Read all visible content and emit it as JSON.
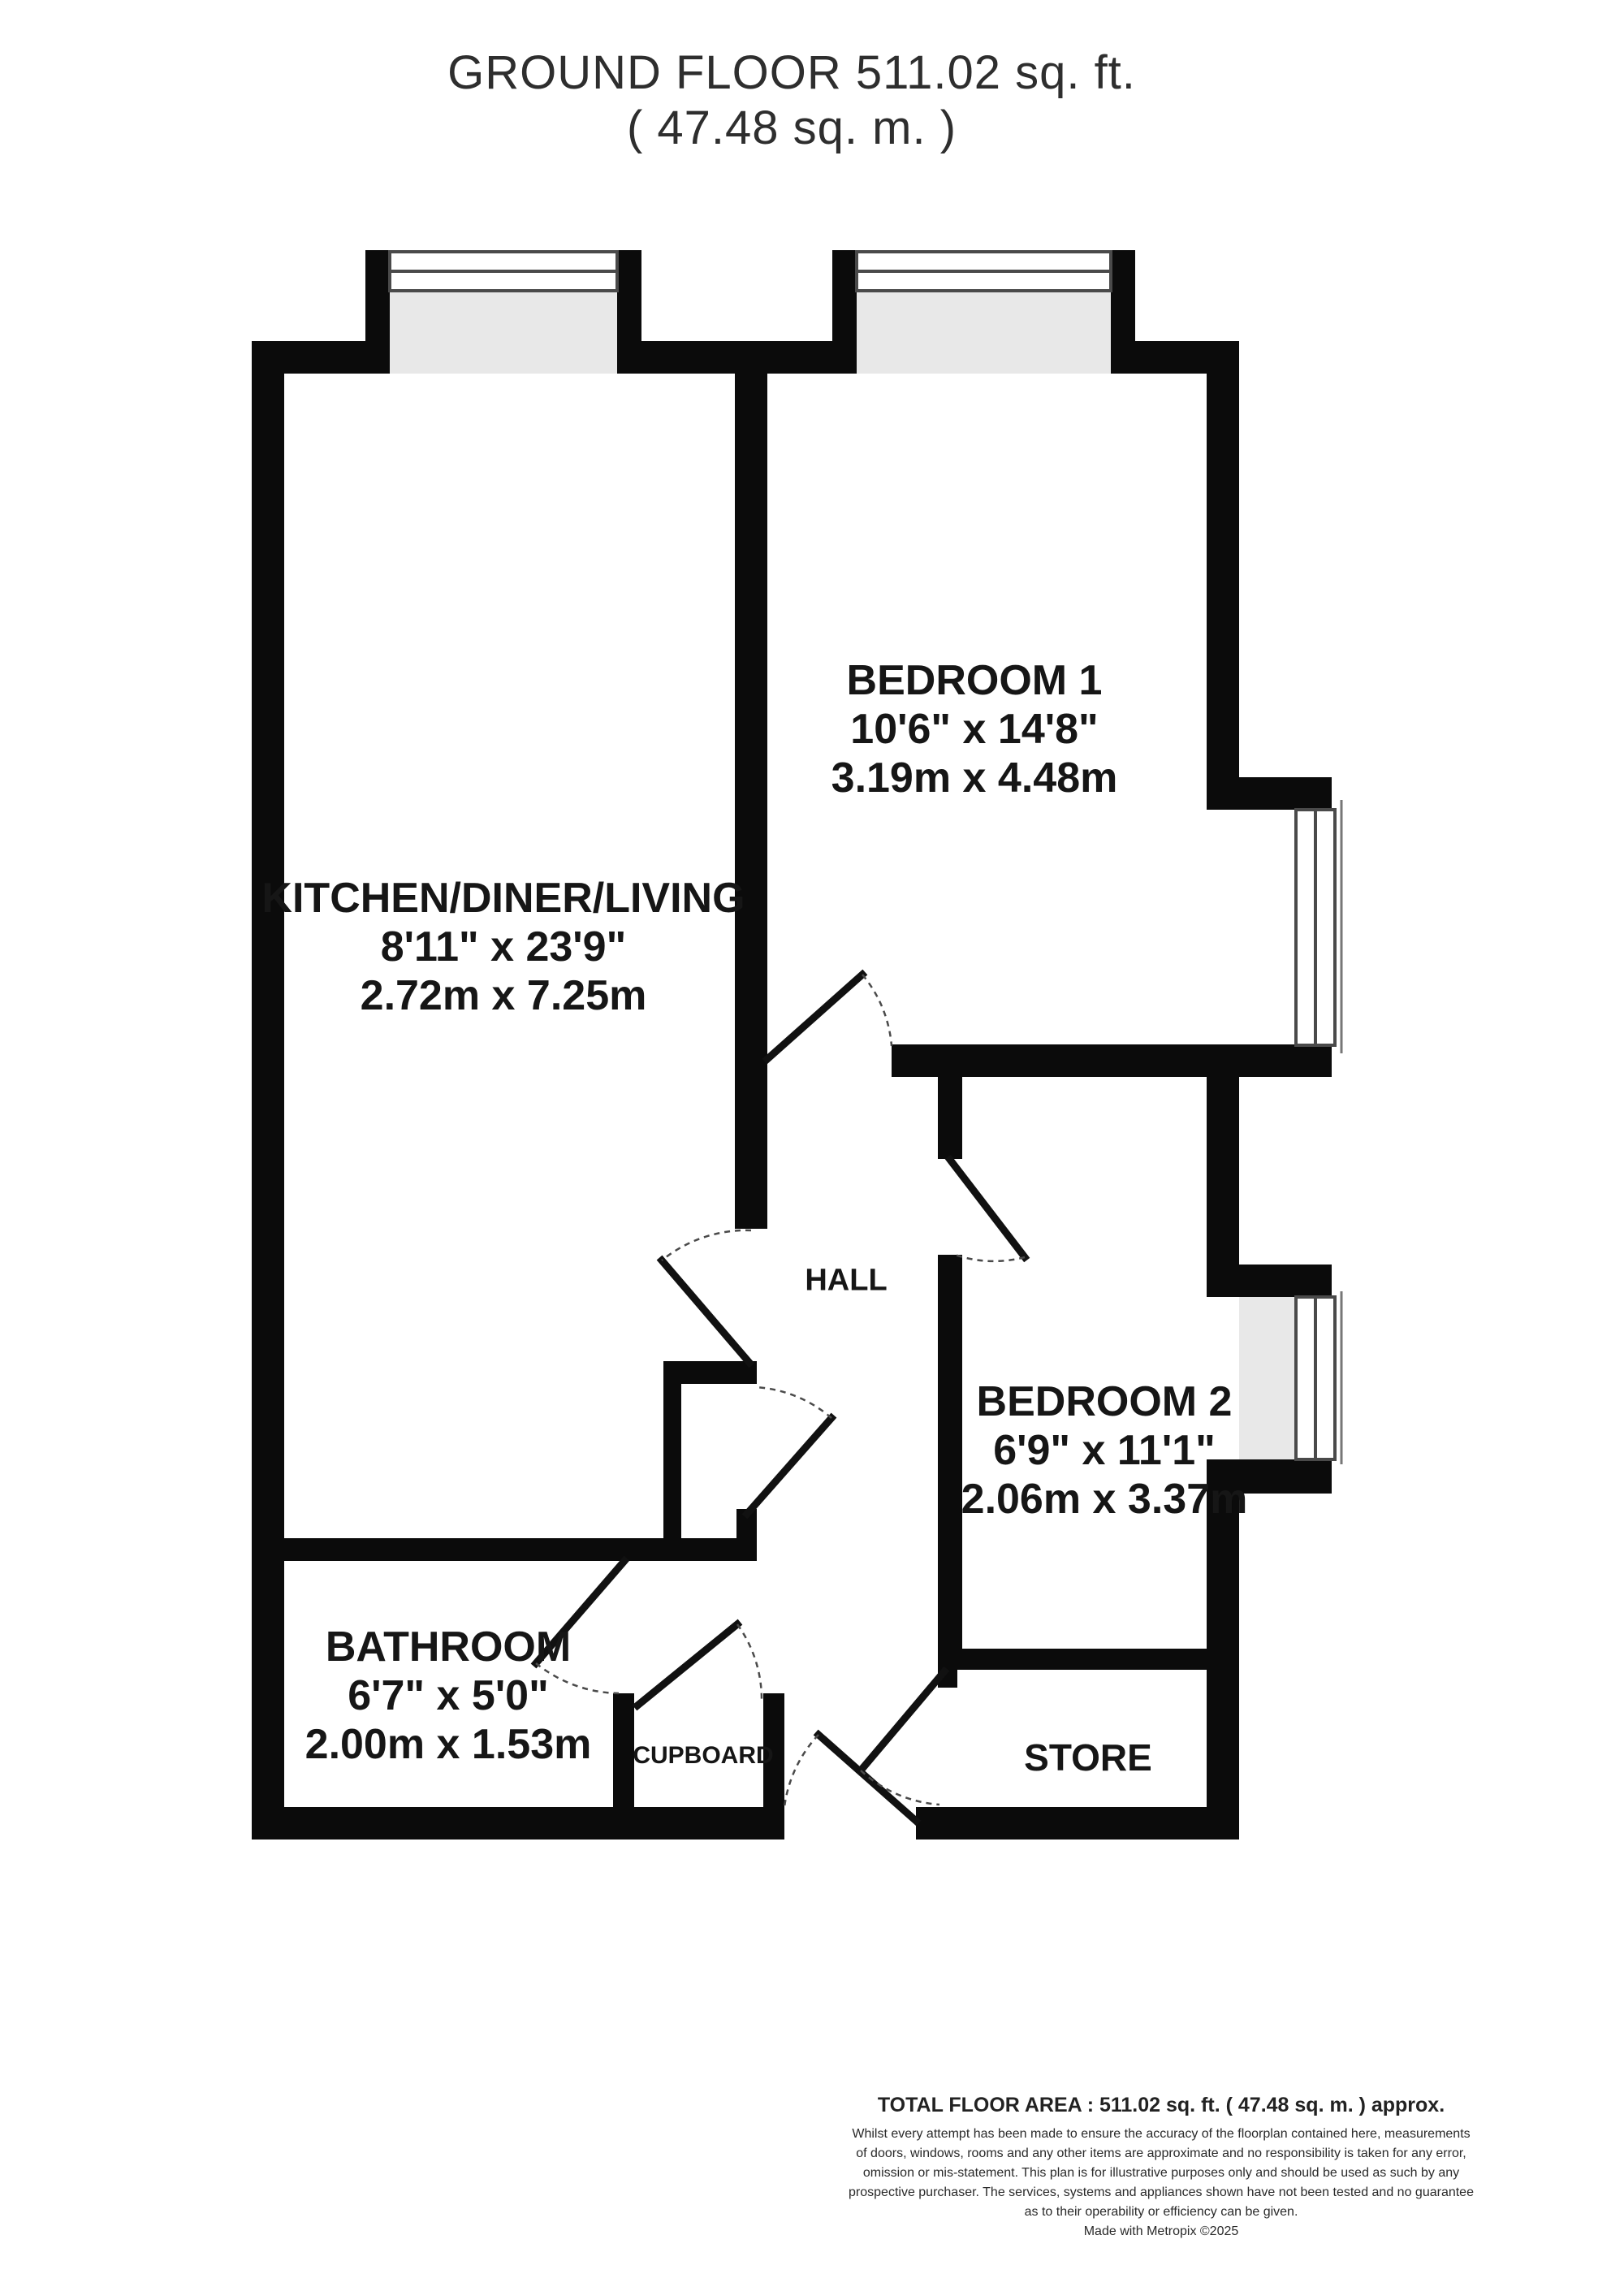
{
  "title": {
    "line1": "GROUND FLOOR 511.02 sq. ft.",
    "line2": "( 47.48 sq. m. )"
  },
  "rooms": {
    "bedroom1": {
      "name": "BEDROOM 1",
      "imperial": "10'6\" x 14'8\"",
      "metric": "3.19m x 4.48m"
    },
    "kitchen": {
      "name": "KITCHEN/DINER/LIVING",
      "imperial": "8'11\" x 23'9\"",
      "metric": "2.72m x 7.25m"
    },
    "bedroom2": {
      "name": "BEDROOM 2",
      "imperial": "6'9\" x 11'1\"",
      "metric": "2.06m x 3.37m"
    },
    "bathroom": {
      "name": "BATHROOM",
      "imperial": "6'7\" x 5'0\"",
      "metric": "2.00m x 1.53m"
    },
    "hall": {
      "name": "HALL"
    },
    "cupboard": {
      "name": "CUPBOARD"
    },
    "store": {
      "name": "STORE"
    }
  },
  "footer": {
    "total": "TOTAL FLOOR AREA : 511.02 sq. ft. ( 47.48 sq. m. ) approx.",
    "disclaimer": [
      "Whilst every attempt has been made to ensure the accuracy of the floorplan contained here, measurements",
      "of doors, windows, rooms and any other items are approximate and no responsibility is taken for any error,",
      "omission or mis-statement. This plan is for illustrative purposes only and should be used as such by any",
      "prospective purchaser. The services, systems and appliances shown have not been tested and no guarantee",
      "as to their operability or efficiency can be given."
    ],
    "credit": "Made with Metropix ©2025"
  },
  "colors": {
    "wall": "#0b0b0b",
    "window_recess": "#e8e8e8",
    "window_line": "#4a4a4a",
    "door_arc": "#4a4a4a",
    "text": "#161616"
  }
}
